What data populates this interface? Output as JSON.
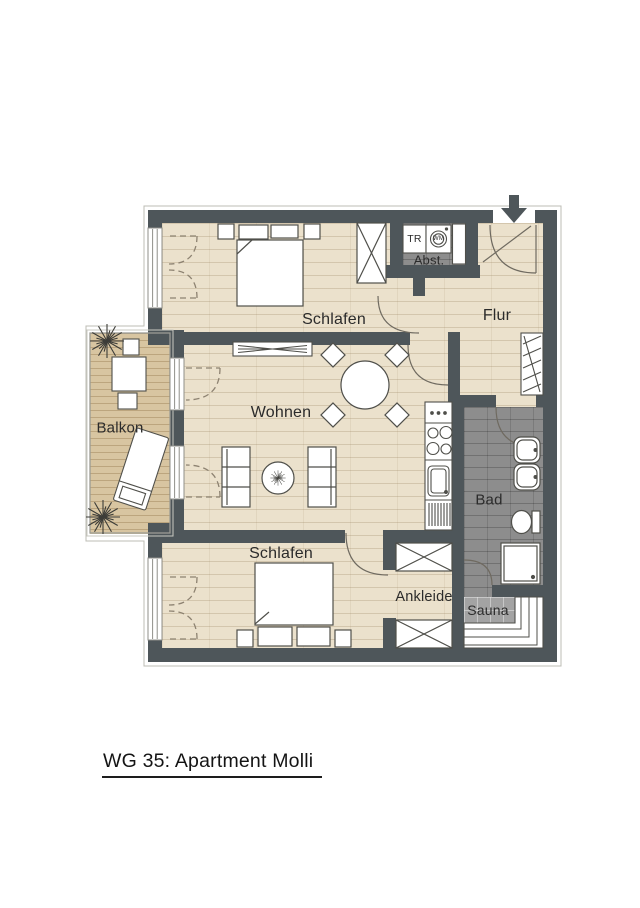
{
  "title": "WG 35: Apartment Molli",
  "plan": {
    "rooms": [
      {
        "id": "schlafen-top",
        "label": "Schlafen"
      },
      {
        "id": "flur",
        "label": "Flur"
      },
      {
        "id": "abstellraum",
        "label": "Abst."
      },
      {
        "id": "wohnen",
        "label": "Wohnen"
      },
      {
        "id": "balkon",
        "label": "Balkon"
      },
      {
        "id": "bad",
        "label": "Bad"
      },
      {
        "id": "schlafen-bottom",
        "label": "Schlafen"
      },
      {
        "id": "ankleide",
        "label": "Ankleide"
      },
      {
        "id": "sauna",
        "label": "Sauna"
      }
    ],
    "appliances": [
      {
        "id": "dryer",
        "label": "TR"
      },
      {
        "id": "washing-machine",
        "label": "WM"
      }
    ],
    "icons": [
      "entrance-arrow-icon",
      "plant-icon",
      "washing-machine-icon",
      "dryer-icon"
    ],
    "colors": {
      "wall": "#4e565a",
      "wood_floor": "#ebe1cc",
      "balcony_deck": "#d8c5a1",
      "tile_dark": "#8d8d8d",
      "tile_light": "#a3a3a3",
      "line": "#4f4f4a"
    }
  }
}
